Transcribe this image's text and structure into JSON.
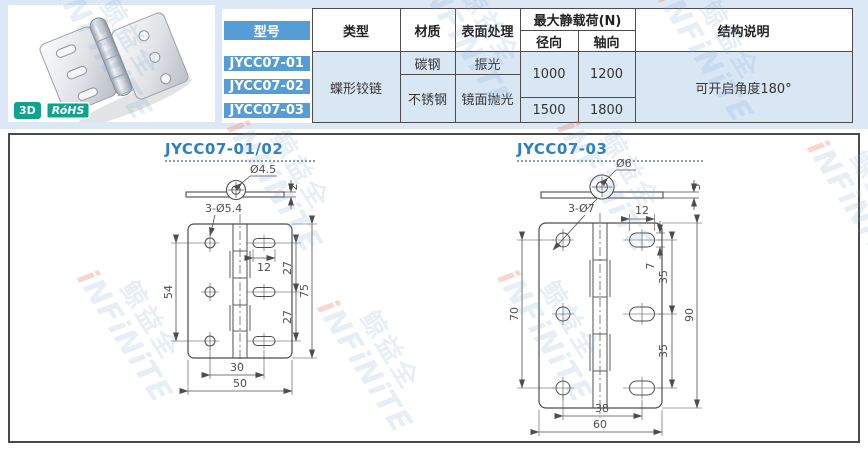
{
  "photo": {
    "badges": [
      {
        "label": "3D"
      },
      {
        "label": "RóHS"
      }
    ]
  },
  "table": {
    "header": {
      "model": "型号",
      "type": "类型",
      "material": "材质",
      "surface": "表面处理",
      "max_load": "最大静载荷(N)",
      "radial": "径向",
      "axial": "轴向",
      "structure": "结构说明"
    },
    "models": [
      "JYCC07-01",
      "JYCC07-02",
      "JYCC07-03"
    ],
    "type_value": "蝶形铰链",
    "material_row1": "碳钢",
    "material_row23": "不锈钢",
    "surface_row1": "振光",
    "surface_row23": "镜面抛光",
    "load_radial_row12": "1000",
    "load_axial_row12": "1200",
    "load_radial_row3": "1500",
    "load_axial_row3": "1800",
    "structure_value": "可开启角度180°"
  },
  "drawings": {
    "left": {
      "title": "JYCC07-01/02",
      "pin_dia": "Ø4.5",
      "plate_thickness": "2",
      "holes_label": "3-Ø5.4",
      "slot_length": "12",
      "pitch_top": "27",
      "pitch_bottom": "27",
      "total_height": "75",
      "hole_span": "54",
      "hole_offset": "30",
      "total_width": "50"
    },
    "right": {
      "title": "JYCC07-03",
      "pin_dia": "Ø6",
      "plate_thickness": "3",
      "holes_label": "3-Ø7",
      "slot_length": "12",
      "slot_width": "7",
      "pitch_top": "35",
      "pitch_bottom": "35",
      "total_height": "90",
      "hole_span": "70",
      "hole_offset": "38",
      "total_width": "60"
    }
  },
  "watermark": {
    "cn": "鲸益全",
    "en": "iNFiNiTE"
  },
  "colors": {
    "band": "#dce8f5",
    "model_blue": "#569dd6",
    "cell_blue": "#d9e7f5",
    "title_blue": "#2e7fc0",
    "badge_teal": "#0fa28c",
    "line": "#4d4d4d"
  }
}
